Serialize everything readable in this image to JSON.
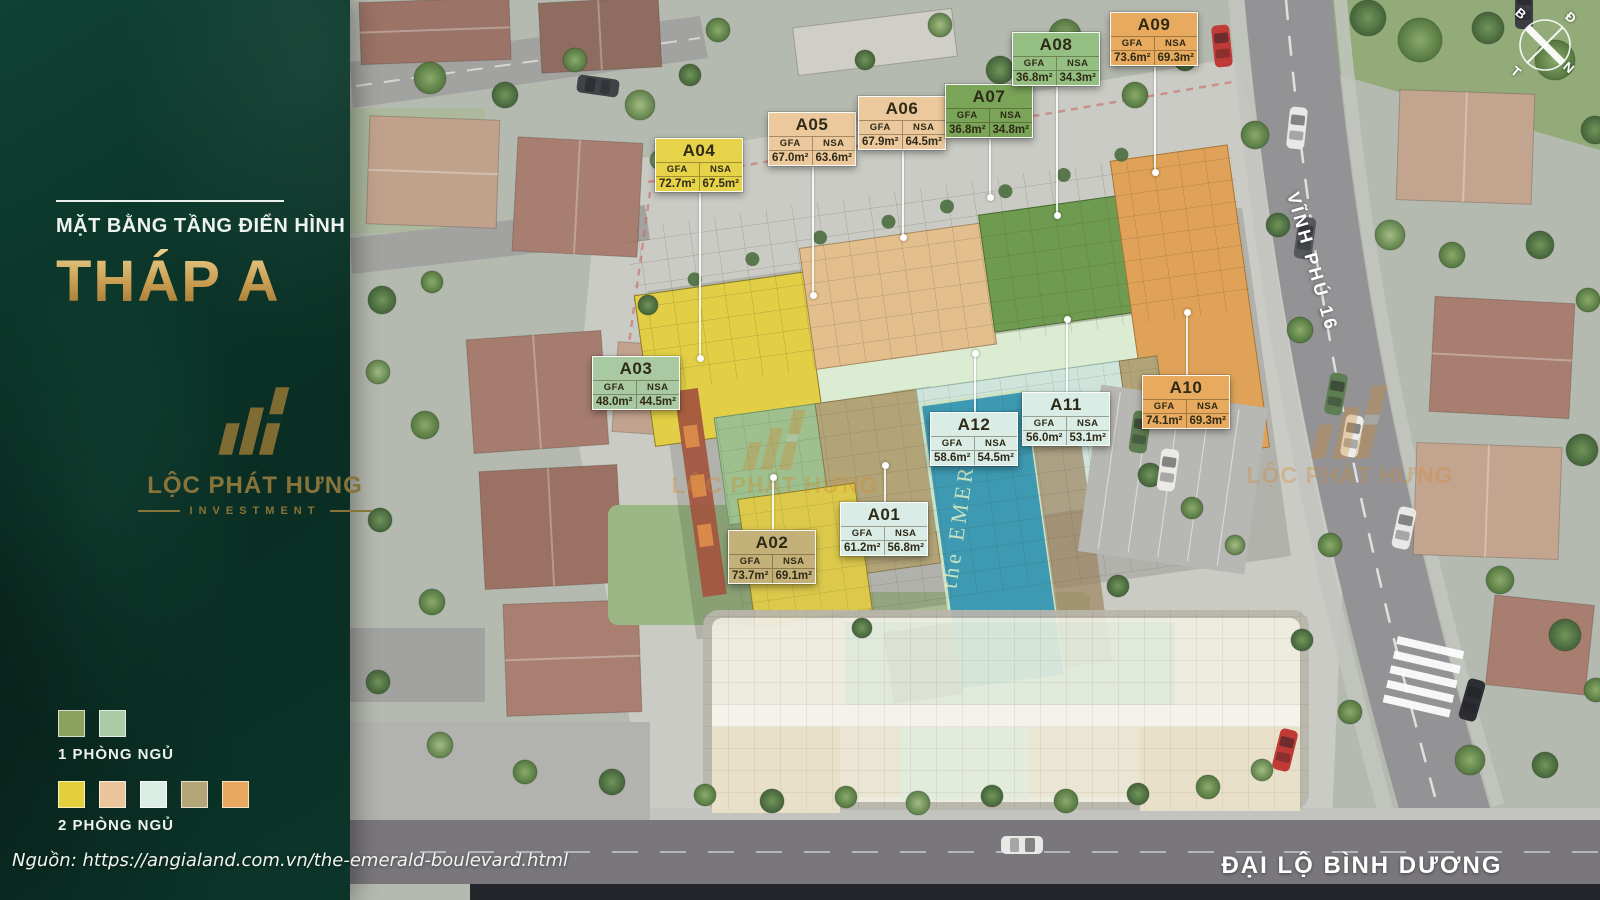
{
  "sidebar": {
    "subtitle": "MẶT BẰNG TẦNG ĐIỂN HÌNH",
    "title": "THÁP A",
    "logo": {
      "name": "LỘC PHÁT HƯNG",
      "sub": "INVESTMENT"
    },
    "legend": [
      {
        "label": "1 PHÒNG NGỦ",
        "colors": [
          "#8BA15E",
          "#ABCAA6"
        ]
      },
      {
        "label": "2 PHÒNG NGỦ",
        "colors": [
          "#E4D03C",
          "#ECC69A",
          "#DAEEE6",
          "#B4A676",
          "#E8A85F"
        ]
      }
    ],
    "source": "Nguồn: https://angialand.com.vn/the-emerald-boulevard.html"
  },
  "map": {
    "col_headers": [
      "GFA",
      "NSA"
    ],
    "units": [
      {
        "id": "A01",
        "gfa": "61.2m²",
        "nsa": "56.8m²",
        "color": "#D9ECE5",
        "x": 840,
        "y": 502,
        "leader": {
          "side": "top",
          "len": 36
        }
      },
      {
        "id": "A02",
        "gfa": "73.7m²",
        "nsa": "69.1m²",
        "color": "#C4B179",
        "x": 728,
        "y": 530,
        "leader": {
          "side": "top",
          "len": 52
        }
      },
      {
        "id": "A03",
        "gfa": "48.0m²",
        "nsa": "44.5m²",
        "color": "#A9C9A2",
        "x": 592,
        "y": 356
      },
      {
        "id": "A04",
        "gfa": "72.7m²",
        "nsa": "67.5m²",
        "color": "#E6D34A",
        "x": 655,
        "y": 138,
        "leader": {
          "side": "bottom",
          "len": 165
        }
      },
      {
        "id": "A05",
        "gfa": "67.0m²",
        "nsa": "63.6m²",
        "color": "#ECC99D",
        "x": 768,
        "y": 112,
        "leader": {
          "side": "bottom",
          "len": 128
        }
      },
      {
        "id": "A06",
        "gfa": "67.9m²",
        "nsa": "64.5m²",
        "color": "#ECC99D",
        "x": 858,
        "y": 96,
        "leader": {
          "side": "bottom",
          "len": 86
        }
      },
      {
        "id": "A07",
        "gfa": "36.8m²",
        "nsa": "34.8m²",
        "color": "#7AA458",
        "x": 945,
        "y": 84,
        "leader": {
          "side": "bottom",
          "len": 58
        }
      },
      {
        "id": "A08",
        "gfa": "36.8m²",
        "nsa": "34.3m²",
        "color": "#95BF82",
        "x": 1012,
        "y": 32,
        "leader": {
          "side": "bottom",
          "len": 128
        }
      },
      {
        "id": "A09",
        "gfa": "73.6m²",
        "nsa": "69.3m²",
        "color": "#E8AA5E",
        "x": 1110,
        "y": 12,
        "leader": {
          "side": "bottom",
          "len": 105
        }
      },
      {
        "id": "A10",
        "gfa": "74.1m²",
        "nsa": "69.3m²",
        "color": "#E8AA5E",
        "x": 1142,
        "y": 375,
        "leader": {
          "side": "top",
          "len": 62
        }
      },
      {
        "id": "A11",
        "gfa": "56.0m²",
        "nsa": "53.1m²",
        "color": "#D9ECE5",
        "x": 1022,
        "y": 392,
        "leader": {
          "side": "top",
          "len": 72
        }
      },
      {
        "id": "A12",
        "gfa": "58.6m²",
        "nsa": "54.5m²",
        "color": "#D9ECE5",
        "x": 930,
        "y": 412,
        "leader": {
          "side": "top",
          "len": 58
        }
      }
    ],
    "streets": [
      "VĨNH PHÚ 16",
      "ĐẠI LỘ BÌNH DƯƠNG"
    ],
    "pool_text": "the EMERALD",
    "compass": {
      "letters": [
        "B",
        "Đ",
        "T",
        "N"
      ]
    }
  },
  "watermark": {
    "text": "LỘC PHÁT HƯNG"
  }
}
